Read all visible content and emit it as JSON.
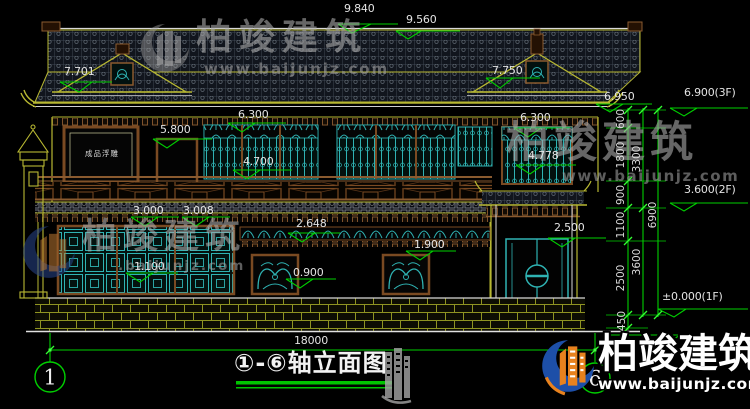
{
  "watermark": {
    "brand": "柏竣建筑",
    "url": "www.baijunjz.com",
    "url_partial": ".baijunjz.com"
  },
  "title": {
    "text": "①-⑥轴立面图"
  },
  "axis": {
    "left": "1",
    "right": "6"
  },
  "labels": {
    "relief_panel": "成品浮雕"
  },
  "dims": {
    "d9840": "9.840",
    "d9560": "9.560",
    "d7701": "7.701",
    "d7750": "7.750",
    "d6950": "6.950",
    "d6900_3f": "6.900(3F)",
    "d6300_left": "6.300",
    "d6300_right": "6.300",
    "d5800": "5.800",
    "d4700": "4.700",
    "d4778": "4.778",
    "d3600_2f": "3.600(2F)",
    "d3000": "3.000",
    "d3008": "3.008",
    "d2648": "2.648",
    "d2500": "2.500",
    "d1900": "1.900",
    "d1100": "1.100",
    "d0900": "0.900",
    "d0000_1f": "±0.000(1F)",
    "d0450": "0.450",
    "total_width": "18000",
    "v600": "600",
    "v1800": "1800",
    "v900": "900",
    "v1100": "1100",
    "v2500": "2500",
    "v450": "450",
    "v3300": "3300",
    "v3600": "3600",
    "v6900": "6900"
  },
  "colors": {
    "dim_green": "#00cf00",
    "line_yellow": "#b8b832",
    "lattice_teal": "#2fb3b3",
    "wood_brown": "#8a5a2f",
    "logo_blue": "#1d4fa8",
    "logo_orange": "#e8821e"
  }
}
